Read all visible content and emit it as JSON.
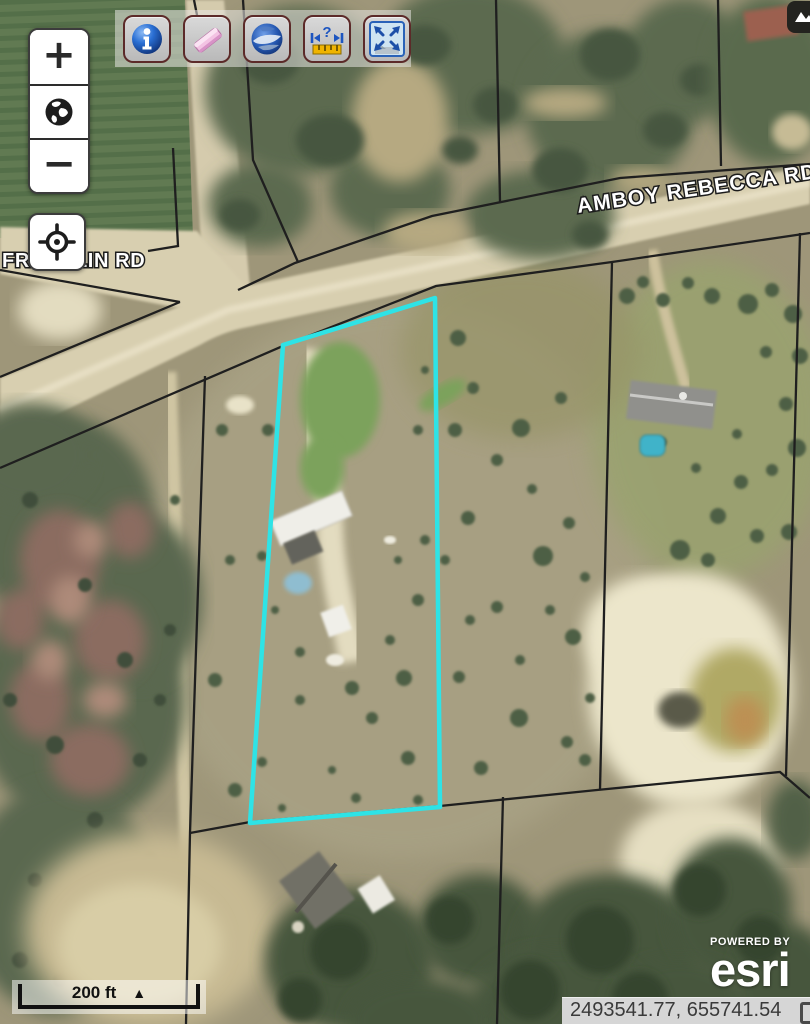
{
  "road_labels": {
    "amboy": "AMBOY REBECCA RD",
    "franklin": "FRANKLIN RD"
  },
  "controls": {
    "zoom_in": "+",
    "zoom_out": "−"
  },
  "toolbar": {
    "buttons": [
      "identify",
      "erase",
      "google-earth",
      "measure",
      "full-extent"
    ]
  },
  "icons": {
    "identify-icon": "blue glossy info sphere",
    "eraser-icon": "pink eraser",
    "google-earth-icon": "blue globe swirl",
    "measure-icon": "blue arrows with ? over yellow ruler",
    "full-extent-icon": "four arrows to corners",
    "globe-icon": "black earth glyph",
    "locate-icon": "crosshair",
    "corner-icon": "dark clipped button"
  },
  "scale_bar": {
    "label": "200 ft",
    "triangle": "▲"
  },
  "attribution": {
    "powered_by": "POWERED BY",
    "brand": "esri"
  },
  "status_bar": {
    "coordinates": "2493541.77, 655741.54"
  },
  "parcel_highlight_color": "#2ee3e6",
  "boundary_line_color": "#1f1f1f"
}
